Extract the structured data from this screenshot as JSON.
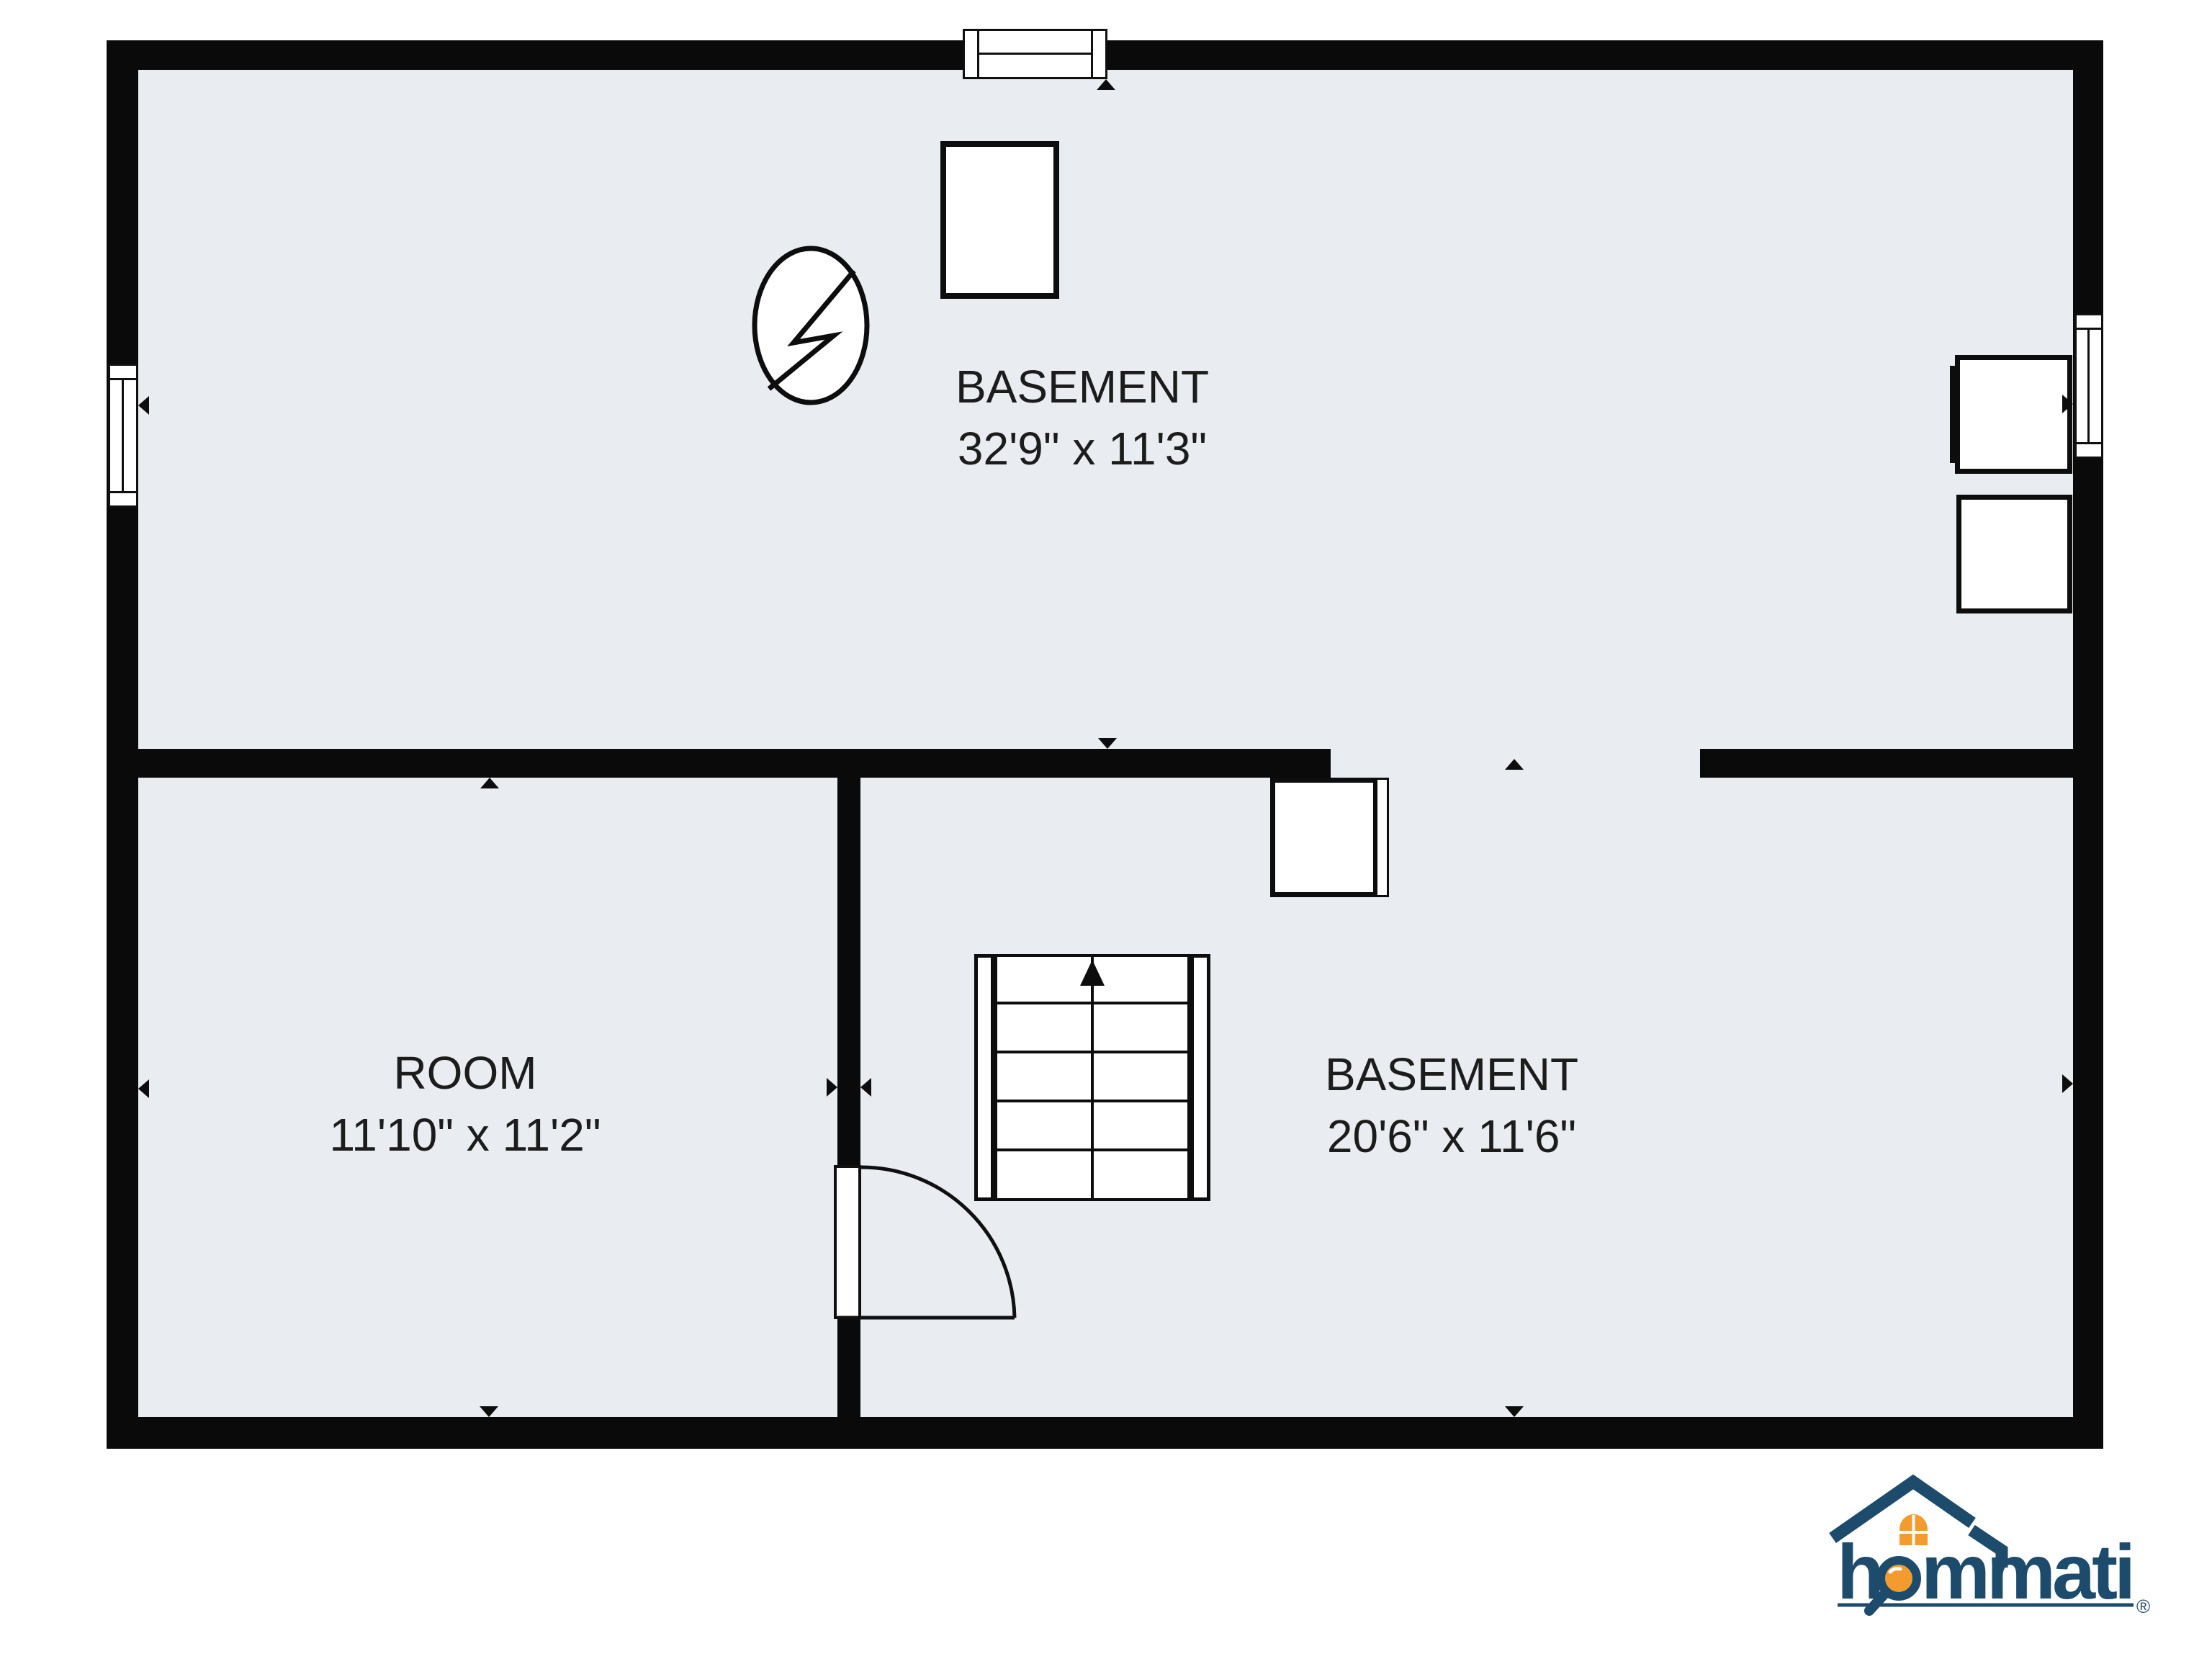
{
  "plan": {
    "interior_color": "#e9edf1",
    "wall_color": "#0a0a0a",
    "rooms": [
      {
        "name": "BASEMENT",
        "dims": "32'9\" x 11'3\""
      },
      {
        "name": "ROOM",
        "dims": "11'10\" x 11'2\""
      },
      {
        "name": "BASEMENT",
        "dims": "20'6\" x 11'6\""
      }
    ]
  },
  "logo": {
    "brand": "hommati",
    "brand_h": "h",
    "brand_rest": "mmati",
    "registered": "®",
    "navy": "#1d4b6c",
    "orange": "#f49b2d"
  }
}
